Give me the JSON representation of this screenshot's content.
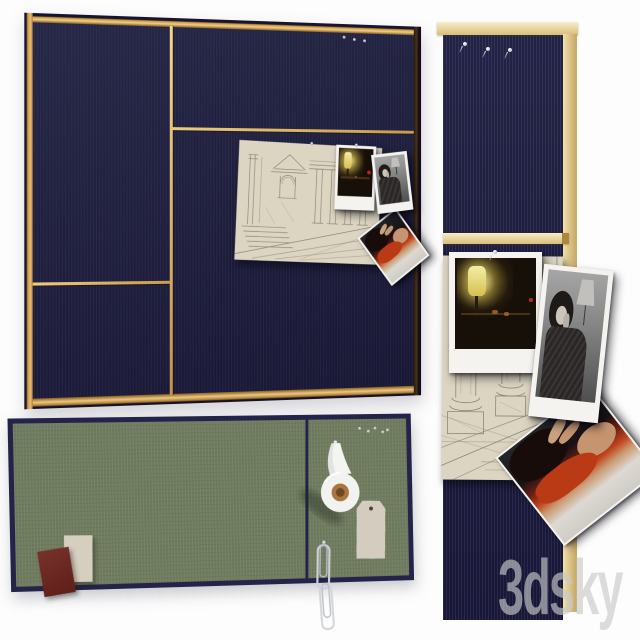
{
  "watermark": {
    "text": "3dsky",
    "color": "#cacaca"
  },
  "scene": {
    "type": "3d-render-product-presentation",
    "subject": "fabric wall pin boards with pinned photos and stationery",
    "background": "#ffffff",
    "boards": {
      "square_board": {
        "name": "navy square pin board with brass frame",
        "fabric_color": "#1b1b3c",
        "frame_colors": [
          "#f0d088",
          "#c9973f",
          "#2a1c08"
        ],
        "divider_color": "#e8c878",
        "pin_count": 3,
        "pinned_items": [
          "architectural sketch",
          "night lamp polaroid",
          "black and white portrait photo",
          "tilted color photo"
        ]
      },
      "green_board": {
        "name": "green rectangular pin board with navy frame",
        "fabric_color": "#6f7b5e",
        "frame_color": "#24244a",
        "sections": 2,
        "pin_count": 5,
        "pinned_items": [
          "beige card",
          "maroon card",
          "white tape roll",
          "paper tag",
          "paper clip chain"
        ]
      },
      "detail_board": {
        "name": "navy pin board close-up with pale brass trim",
        "fabric_color": "#1e1e44",
        "trim_color": "#e6d098",
        "pin_count": 3,
        "pinned_items": [
          "night lamp polaroid",
          "black and white portrait photo",
          "architectural column sketch",
          "tilted color photo"
        ]
      }
    }
  }
}
